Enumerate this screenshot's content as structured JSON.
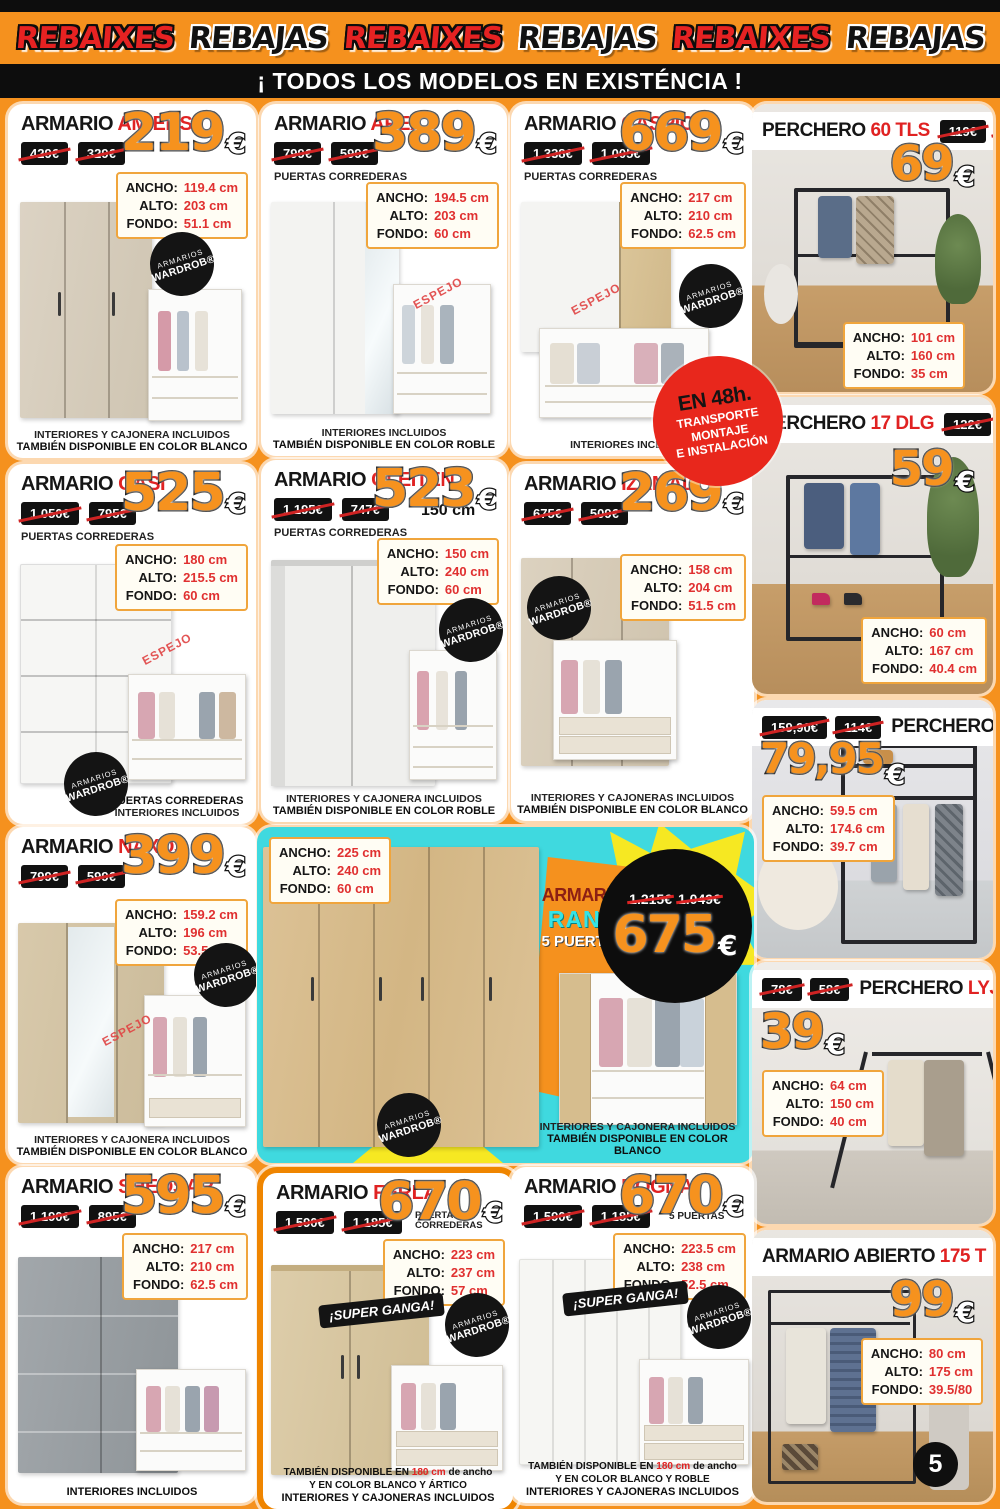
{
  "colors": {
    "orange": "#f5911e",
    "red": "#e02222",
    "cyan": "#3fd9df",
    "yellow": "#f6e822",
    "black": "#0d0d0d"
  },
  "banner": {
    "words": [
      {
        "text": "REBAIXES"
      },
      {
        "text": "REBAJAS"
      },
      {
        "text": "REBAIXES"
      },
      {
        "text": "REBAJAS"
      },
      {
        "text": "REBAIXES"
      },
      {
        "text": "REBAJAS"
      }
    ]
  },
  "headline": "¡ TODOS LOS MODELOS EN EXISTÉNCIA !",
  "page_number": "5",
  "currency": "€",
  "labels": {
    "ancho": "ANCHO:",
    "alto": "ALTO:",
    "fondo": "FONDO:"
  },
  "badges": {
    "wardrob_top": "ARMARIOS",
    "wardrob_bottom": "WARDROB®",
    "espejo": "ESPEJO",
    "super_ganga": "¡SUPER GANGA!",
    "delivery": {
      "l1": "EN 48h.",
      "l2": "TRANSPORTE",
      "l3": "MONTAJE",
      "l4": "E INSTALACIÓN"
    }
  },
  "products": {
    "amiens": {
      "kind": "ARMARIO",
      "name": "AMIENS",
      "old1": "429€",
      "old2": "329€",
      "price": "219",
      "ancho": "119.4 cm",
      "alto": "203 cm",
      "fondo": "51.1 cm",
      "note1": "INTERIORES Y CAJONERA INCLUIDOS",
      "note2": "TAMBIÉN DISPONIBLE EN COLOR BLANCO"
    },
    "apex": {
      "kind": "ARMARIO",
      "name": "APEX",
      "old1": "799€",
      "old2": "599€",
      "sub": "PUERTAS CORREDERAS",
      "price": "389",
      "ancho": "194.5 cm",
      "alto": "203 cm",
      "fondo": "60 cm",
      "note1": "INTERIORES INCLUIDOS",
      "note2": "TAMBIÉN DISPONIBLE EN COLOR ROBLE"
    },
    "caspio": {
      "kind": "ARMARIO",
      "name": "CASPIO",
      "old1": "1.338€",
      "old2": "1.005€",
      "sub": "PUERTAS CORREDERAS",
      "price": "669",
      "ancho": "217 cm",
      "alto": "210 cm",
      "fondo": "62.5 cm",
      "note1": "INTERIORES INCLUIDOS"
    },
    "p60tls": {
      "kind": "PERCHERO",
      "name": "60 TLS",
      "old1": "119€",
      "old2": "89€",
      "price": "69",
      "ancho": "101 cm",
      "alto": "160 cm",
      "fondo": "35 cm"
    },
    "gasi": {
      "kind": "ARMARIO",
      "name": "GASI",
      "old1": "1.050€",
      "old2": "795€",
      "sub": "PUERTAS CORREDERAS",
      "price": "525",
      "ancho": "180 cm",
      "alto": "215.5 cm",
      "fondo": "60 cm",
      "note1": "PUERTAS CORREDERAS",
      "note2": "INTERIORES INCLUIDOS"
    },
    "gleiten": {
      "kind": "ARMARIO",
      "name": "GLEITEN",
      "old1": "1.195€",
      "old2": "747€",
      "size_tag": "150 cm",
      "sub": "PUERTAS CORREDERAS",
      "price": "523",
      "ancho": "150 cm",
      "alto": "240 cm",
      "fondo": "60 cm",
      "note1": "INTERIORES Y CAJONERA INCLUIDOS",
      "note2": "TAMBIÉN DISPONIBLE EN COLOR ROBLE"
    },
    "izamal": {
      "kind": "ARMARIO",
      "name": "IZAMAL",
      "old1": "675€",
      "old2": "509€",
      "price": "269",
      "ancho": "158 cm",
      "alto": "204 cm",
      "fondo": "51.5 cm",
      "note1": "INTERIORES Y CAJONERAS  INCLUIDOS",
      "note2": "TAMBIÉN DISPONIBLE EN COLOR BLANCO"
    },
    "p17dlg": {
      "kind": "PERCHERO",
      "name": "17 DLG",
      "old1": "122€",
      "old2": "92€",
      "price": "59",
      "ancho": "60 cm",
      "alto": "167 cm",
      "fondo": "40.4 cm"
    },
    "p175btl": {
      "kind": "PERCHERO",
      "name": "175 BTL",
      "old1": "159,90€",
      "old2": "114€",
      "price": "79,95",
      "ancho": "59.5 cm",
      "alto": "174.6 cm",
      "fondo": "39.7 cm"
    },
    "naxos": {
      "kind": "ARMARIO",
      "name": "NAXOS",
      "old1": "799€",
      "old2": "599€",
      "price": "399",
      "ancho": "159.2 cm",
      "alto": "196 cm",
      "fondo": "53.5 cm",
      "note1": "INTERIORES Y CAJONERA INCLUIDOS",
      "note2": "TAMBIÉN DISPONIBLE EN COLOR BLANCO"
    },
    "rank": {
      "kind": "ARMARIO",
      "name": "RANK",
      "sub": "5 PUERTAS",
      "old1": "1.215€",
      "old2": "1.049€",
      "price": "675",
      "ancho": "225 cm",
      "alto": "240 cm",
      "fondo": "60 cm",
      "note1": "INTERIORES Y CAJONERA INCLUIDOS",
      "note2": "TAMBIÉN DISPONIBLE EN COLOR BLANCO"
    },
    "lyj64": {
      "kind": "PERCHERO",
      "name": "LYJ 64",
      "old1": "78€",
      "old2": "58€",
      "price": "39",
      "ancho": "64 cm",
      "alto": "150 cm",
      "fondo": "40 cm"
    },
    "sheosar": {
      "kind": "ARMARIO",
      "name": "SHEOSAR",
      "old1": "1.190€",
      "old2": "895€",
      "price": "595",
      "ancho": "217 cm",
      "alto": "210 cm",
      "fondo": "62.5 cm",
      "note1": "INTERIORES INCLUIDOS"
    },
    "ferla": {
      "kind": "ARMARIO",
      "name": "FERLA",
      "old1": "1.590€",
      "old2": "1.185€",
      "sub": "PUERTAS CORREDERAS",
      "price": "670",
      "ancho": "223 cm",
      "alto": "237 cm",
      "fondo": "57 cm",
      "fn_a": "TAMBIÉN DISPONIBLE EN ",
      "fn_red": "180 cm",
      "fn_b": " de ancho",
      "fn_c": "Y EN COLOR BLANCO Y ÁRTICO",
      "fn_d": "INTERIORES Y CAJONERAS INCLUIDOS"
    },
    "dogna": {
      "kind": "ARMARIO",
      "name": "DOGNA",
      "old1": "1.590€",
      "old2": "1.185€",
      "sub": "5 PUERTAS",
      "price": "670",
      "ancho": "223.5 cm",
      "alto": "238 cm",
      "fondo": "52.5 cm",
      "fn_a": "TAMBIÉN DISPONIBLE EN ",
      "fn_red": "180 cm",
      "fn_b": " de ancho",
      "fn_c": "Y EN COLOR BLANCO Y ROBLE",
      "fn_d": "INTERIORES Y CAJONERAS INCLUIDOS"
    },
    "ab175t": {
      "kind": "ARMARIO ABIERTO",
      "name": "175 T",
      "old1": "198€",
      "old2": "149€",
      "price": "99",
      "ancho": "80 cm",
      "alto": "175 cm",
      "fondo": "39.5/80"
    }
  }
}
